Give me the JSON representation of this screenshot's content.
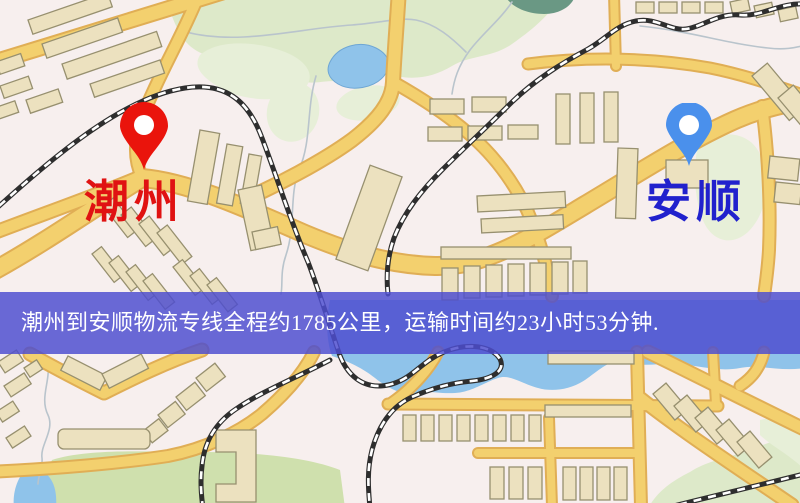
{
  "banner": {
    "text": "潮州到安顺物流专线全程约1785公里，运输时间约23小时53分钟.",
    "bg_color": "#4e4ecf",
    "text_color": "#ffffff"
  },
  "origin_marker": {
    "label": "潮州",
    "label_color": "#e01212",
    "pin_color": "#ea140c"
  },
  "destination_marker": {
    "label": "安顺",
    "label_color": "#2121cd",
    "pin_color": "#4a90ec"
  },
  "map_colors": {
    "background": "#f7efee",
    "park": "#dde9c9",
    "park_light": "#e7efd8",
    "field": "#cfe0ad",
    "water": "#8fc3ea",
    "pond": "#6a9884",
    "stream": "#b9c4cc",
    "road": "#f3d06e",
    "road_casing": "#e0ae55",
    "building": "#ece1bf",
    "building_stroke": "#97906f",
    "railway": "#2e2e2e",
    "railway_dash": "#ffffff"
  }
}
